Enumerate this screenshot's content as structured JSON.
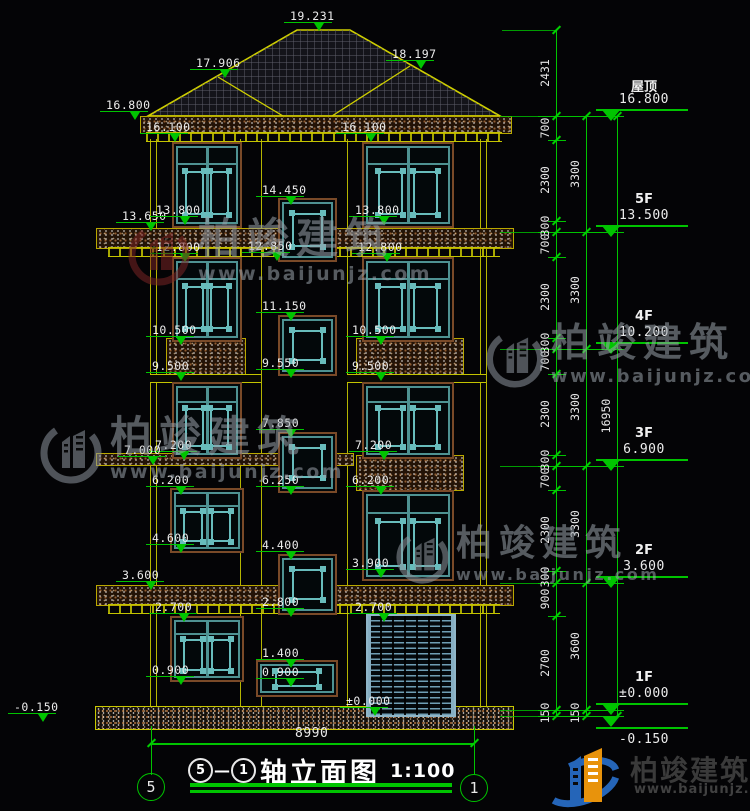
{
  "colors": {
    "dimension_green": "#00c400",
    "wall_yellow": "#c4c400",
    "window_teal": "#4e9292",
    "lattice_teal": "#68bcbc",
    "trim_brown": "#7a4a28",
    "text_white": "#ececec",
    "watermark_gray": "#9aa2aa",
    "watermark_red": "#7a2424",
    "logo_blue": "#2565b8",
    "logo_orange": "#e8930c"
  },
  "elevation_marks": [
    {
      "v": "19.231",
      "x": 290,
      "y": 9
    },
    {
      "v": "17.906",
      "x": 196,
      "y": 56
    },
    {
      "v": "18.197",
      "x": 392,
      "y": 47
    },
    {
      "v": "16.800",
      "x": 106,
      "y": 98
    },
    {
      "v": "16.100",
      "x": 146,
      "y": 120
    },
    {
      "v": "16.100",
      "x": 342,
      "y": 120
    },
    {
      "v": "13.650",
      "x": 122,
      "y": 209
    },
    {
      "v": "13.800",
      "x": 156,
      "y": 203
    },
    {
      "v": "12.800",
      "x": 156,
      "y": 240
    },
    {
      "v": "10.500",
      "x": 152,
      "y": 323
    },
    {
      "v": "9.500",
      "x": 152,
      "y": 359
    },
    {
      "v": "7.200",
      "x": 155,
      "y": 438
    },
    {
      "v": "6.200",
      "x": 152,
      "y": 473
    },
    {
      "v": "4.600",
      "x": 152,
      "y": 531
    },
    {
      "v": "2.700",
      "x": 155,
      "y": 600
    },
    {
      "v": "0.900",
      "x": 152,
      "y": 663
    },
    {
      "v": "7.000",
      "x": 124,
      "y": 443
    },
    {
      "v": "3.600",
      "x": 122,
      "y": 568
    },
    {
      "v": "-0.150",
      "x": 14,
      "y": 700
    },
    {
      "v": "14.450",
      "x": 262,
      "y": 183
    },
    {
      "v": "12.850",
      "x": 248,
      "y": 239
    },
    {
      "v": "11.150",
      "x": 262,
      "y": 299
    },
    {
      "v": "9.550",
      "x": 262,
      "y": 356
    },
    {
      "v": "7.850",
      "x": 262,
      "y": 416
    },
    {
      "v": "6.250",
      "x": 262,
      "y": 473
    },
    {
      "v": "4.400",
      "x": 262,
      "y": 538
    },
    {
      "v": "2.800",
      "x": 262,
      "y": 595
    },
    {
      "v": "1.400",
      "x": 262,
      "y": 646
    },
    {
      "v": "0.900",
      "x": 262,
      "y": 665
    },
    {
      "v": "13.800",
      "x": 355,
      "y": 203
    },
    {
      "v": "12.800",
      "x": 358,
      "y": 240
    },
    {
      "v": "10.500",
      "x": 352,
      "y": 323
    },
    {
      "v": "9.500",
      "x": 352,
      "y": 359
    },
    {
      "v": "7.200",
      "x": 355,
      "y": 438
    },
    {
      "v": "6.200",
      "x": 352,
      "y": 473
    },
    {
      "v": "3.900",
      "x": 352,
      "y": 556
    },
    {
      "v": "2.700",
      "x": 355,
      "y": 600
    },
    {
      "v": "±0.000",
      "x": 346,
      "y": 694
    }
  ],
  "right_dims": {
    "col_a": {
      "ticks": [
        30,
        116,
        140,
        221,
        232,
        257,
        338,
        349,
        374,
        455,
        466,
        490,
        571,
        583,
        616,
        710,
        716
      ],
      "labels": [
        {
          "v": "2431",
          "y": 73
        },
        {
          "v": "700",
          "y": 128
        },
        {
          "v": "2300",
          "y": 180
        },
        {
          "v": "300",
          "y": 226
        },
        {
          "v": "700",
          "y": 244
        },
        {
          "v": "2300",
          "y": 297
        },
        {
          "v": "300",
          "y": 343
        },
        {
          "v": "700",
          "y": 361
        },
        {
          "v": "2300",
          "y": 414
        },
        {
          "v": "300",
          "y": 460
        },
        {
          "v": "700",
          "y": 478
        },
        {
          "v": "2300",
          "y": 530
        },
        {
          "v": "300",
          "y": 577
        },
        {
          "v": "900",
          "y": 599
        },
        {
          "v": "2700",
          "y": 663
        },
        {
          "v": "150",
          "y": 713
        }
      ]
    },
    "col_b": {
      "ticks": [
        116,
        232,
        349,
        466,
        583,
        710,
        716
      ],
      "labels": [
        {
          "v": "3300",
          "y": 174
        },
        {
          "v": "3300",
          "y": 290
        },
        {
          "v": "3300",
          "y": 407
        },
        {
          "v": "3300",
          "y": 524
        },
        {
          "v": "3600",
          "y": 646
        },
        {
          "v": "150",
          "y": 713
        }
      ]
    },
    "col_c": {
      "ticks": [
        116,
        716
      ],
      "labels": [
        {
          "v": "16950",
          "y": 416
        }
      ]
    },
    "floor_markers": [
      {
        "name": "屋顶",
        "value": "16.800",
        "y": 116
      },
      {
        "name": "5F",
        "value": "13.500",
        "y": 232
      },
      {
        "name": "4F",
        "value": "10.200",
        "y": 349
      },
      {
        "name": "3F",
        "value": "6.900",
        "y": 466
      },
      {
        "name": "2F",
        "value": "3.600",
        "y": 583
      },
      {
        "name": "1F",
        "value": "±0.000",
        "y": 710
      },
      {
        "name": "",
        "value": "-0.150",
        "y": 727,
        "below": true
      }
    ]
  },
  "bottom_dim": {
    "value": "8990"
  },
  "axis_bubbles": [
    {
      "label": "5",
      "cx": 151,
      "cy": 787
    },
    {
      "label": "1",
      "cx": 474,
      "cy": 788
    }
  ],
  "title": {
    "axis_from": "5",
    "dash": "—",
    "axis_to": "1",
    "name": "轴立面图",
    "scale": "1:100"
  },
  "watermarks": [
    {
      "text": "柏竣建筑",
      "url": "www.baijunjz.com",
      "x": 128,
      "y": 218,
      "s": 1.0,
      "logo": "red"
    },
    {
      "text": "柏竣建筑",
      "url": "www.baijunjz.com",
      "x": 40,
      "y": 416,
      "s": 1.0,
      "logo": "gray"
    },
    {
      "text": "柏竣建筑",
      "url": "www.baijunjz.com",
      "x": 486,
      "y": 324,
      "s": 0.93,
      "logo": "gray"
    },
    {
      "text": "柏竣建筑",
      "url": "www.baijunjz.com",
      "x": 396,
      "y": 526,
      "s": 0.85,
      "logo": "gray"
    }
  ],
  "footer_logo": {
    "text": "柏竣建筑",
    "url": "www.baijunjz.com"
  }
}
